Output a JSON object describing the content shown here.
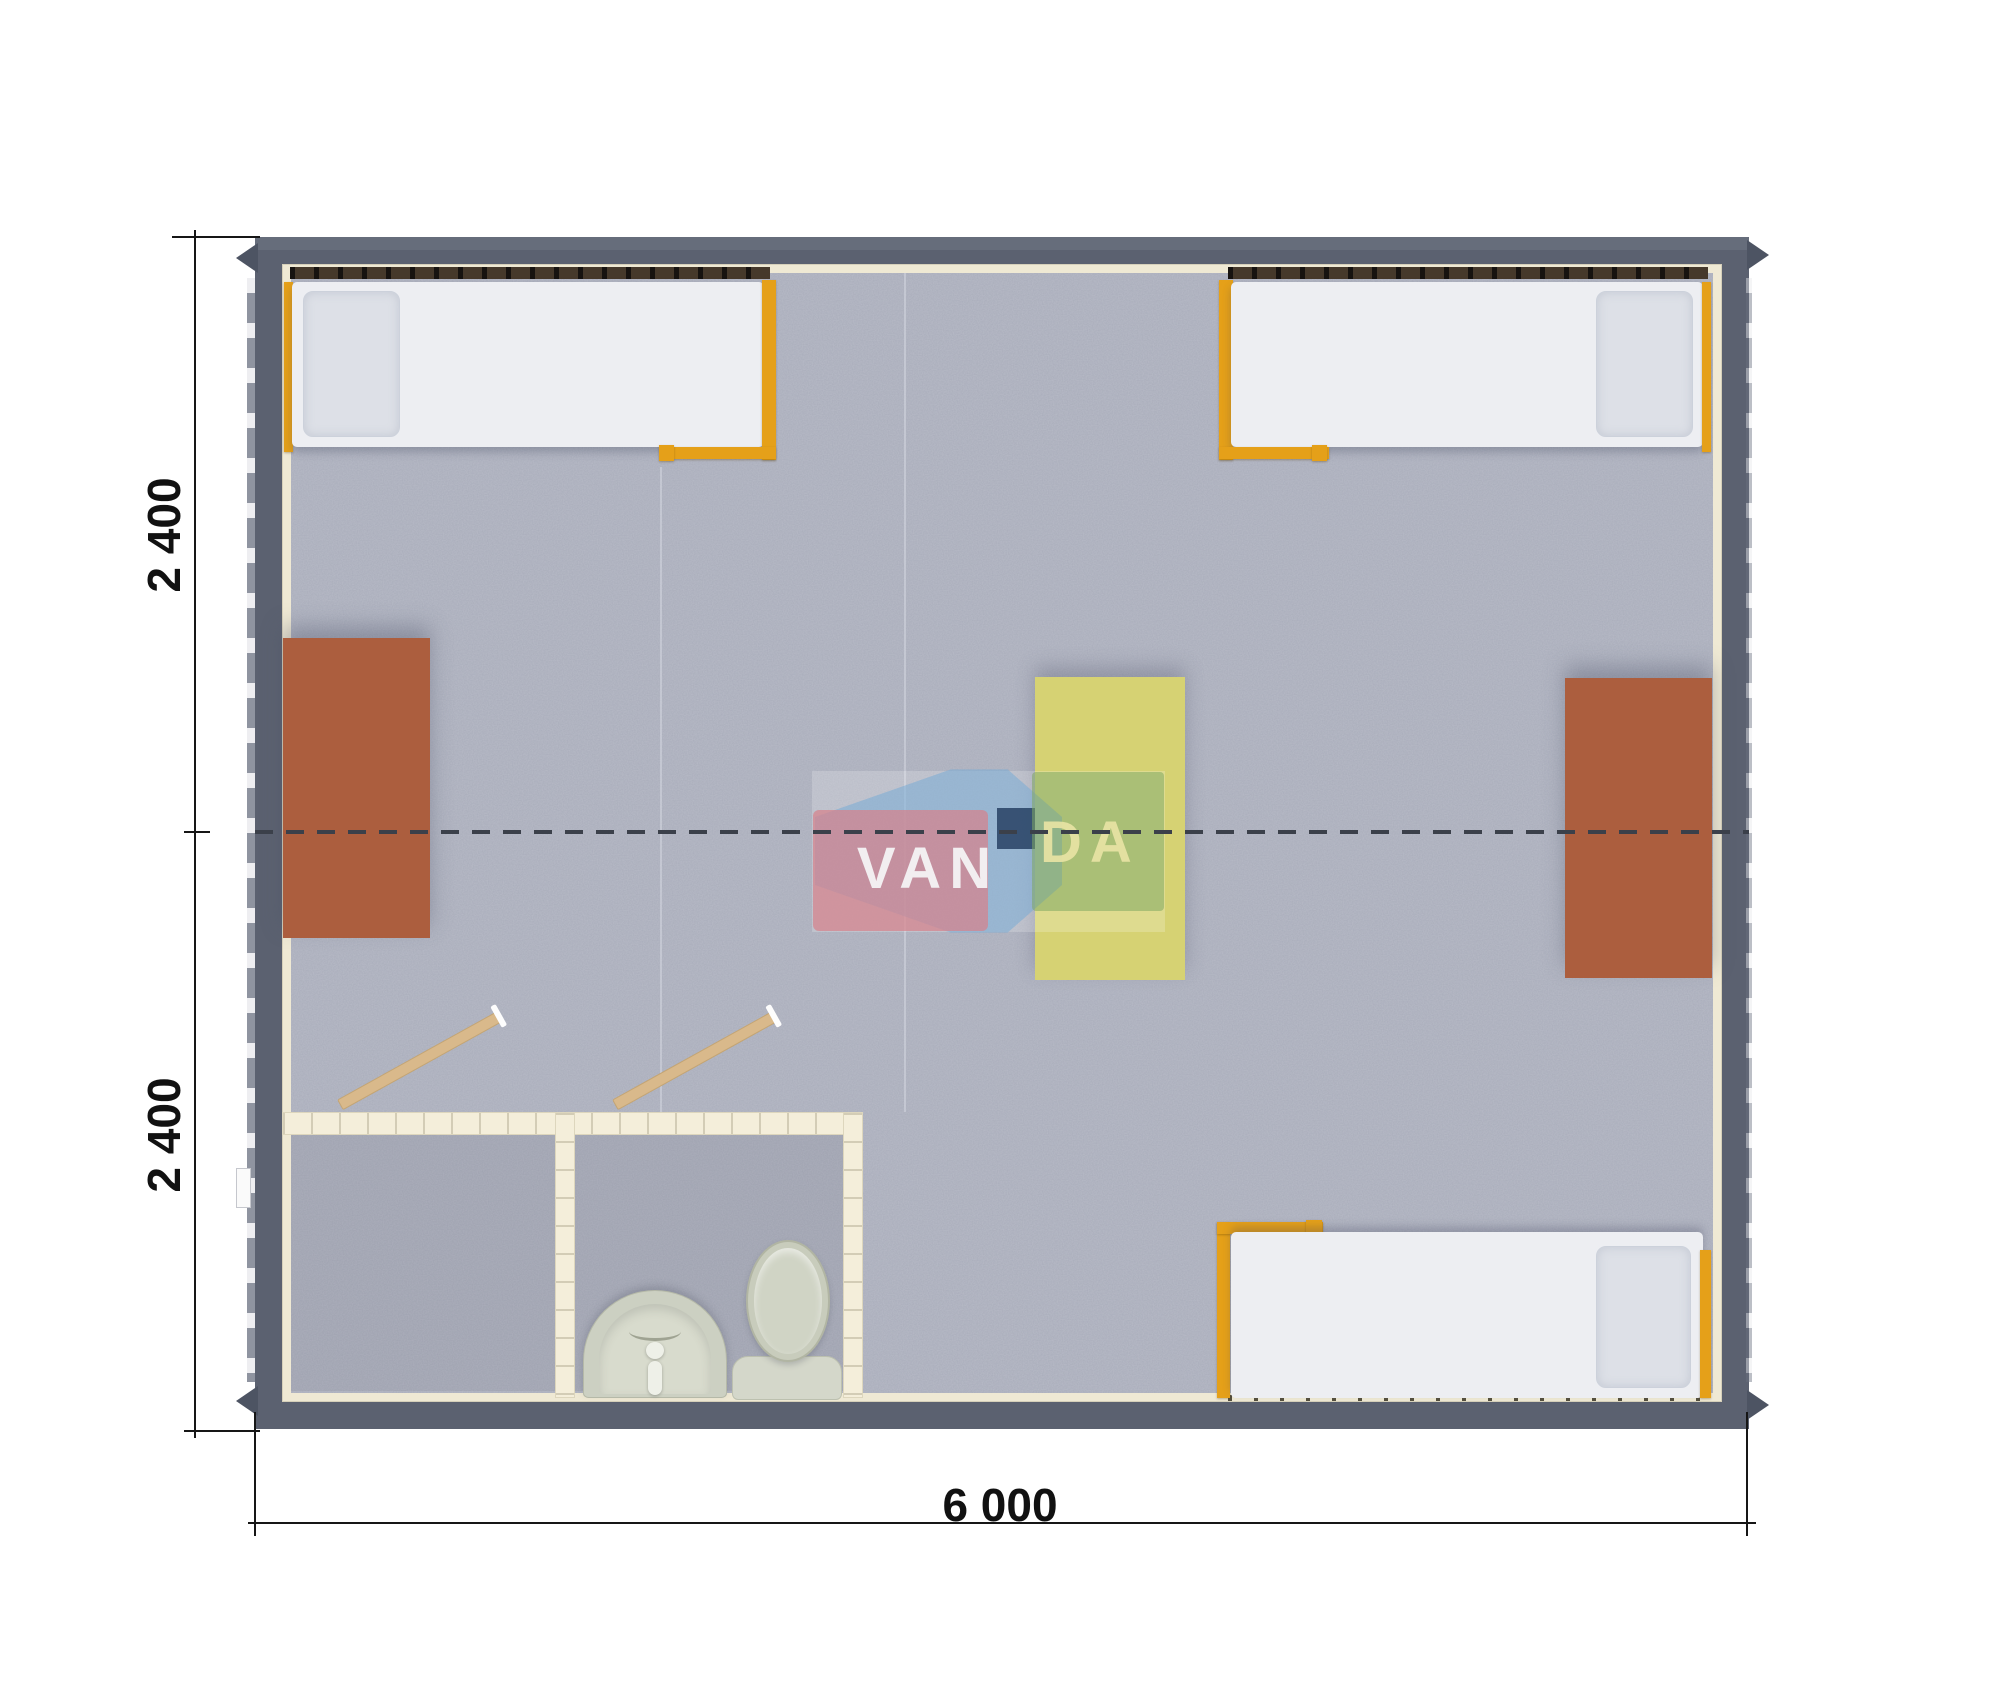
{
  "meta": {
    "kind": "modular cabin floor plan render"
  },
  "watermark": {
    "brand": "VANDA",
    "red_part": "VAN",
    "green_part": "DA"
  },
  "dimensions": {
    "left_top": "2 400",
    "left_bottom": "2 400",
    "bottom": "6 000"
  },
  "palette": {
    "wall": "#5b6170",
    "floor_carpet": "#b8bbc7",
    "liner": "#efe9d4",
    "bed_frame_orange": "#e5a019",
    "mattress": "#edeef2",
    "pillow": "#dde0e7",
    "desk_brown": "#ac5e3e",
    "table_yellow": "#d6d273",
    "bath_wall_cream": "#f4eeda",
    "door_wood": "#d9b98b",
    "fixture_gray": "#ccd0c2",
    "logo_red": "#d6828c",
    "logo_blue": "#78acd6",
    "logo_navy": "#2a4466",
    "logo_green": "#80a862",
    "module_dash_line": "#3b404a",
    "dimension_ink": "#161616"
  },
  "contents": {
    "beds": 3,
    "desks": 2,
    "center_table": 1,
    "wardrobe_doors": 2,
    "shower_room": 1,
    "wc_room": 1,
    "toilet": 1,
    "washbasin": 1
  }
}
